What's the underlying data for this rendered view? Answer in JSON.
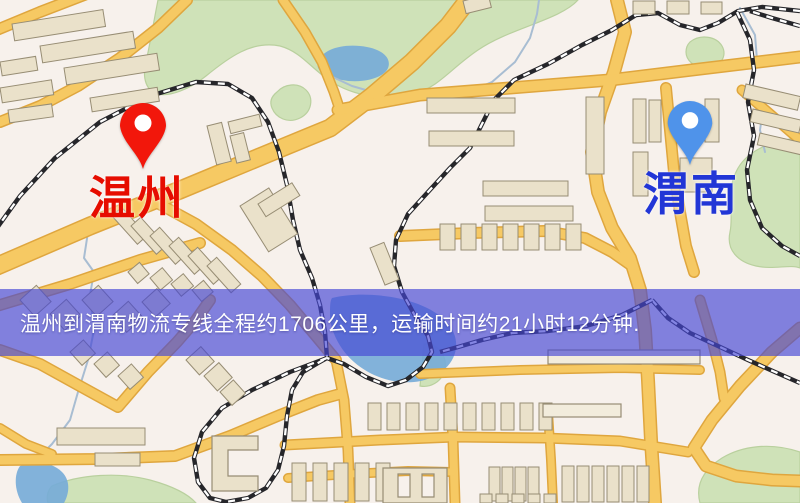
{
  "map": {
    "canvas": {
      "width": 800,
      "height": 503
    },
    "colors": {
      "bg": "#f7f1ec",
      "green": "#cfe2b8",
      "green_stroke": "#b9d09e",
      "water": "#74abd8",
      "stream": "#a8bdd2",
      "road_casing": "#dfa63e",
      "road_fill": "#f6c963",
      "building": "#eae1ca",
      "building_light": "#f2ecdc",
      "building_stroke": "#978d74",
      "rail_dark": "#26262a",
      "rail_light": "#ffffff"
    },
    "markers": [
      {
        "name": "wenzhou",
        "label": "温州",
        "pin_color": "#f2170b",
        "hole_color": "#ffffff",
        "label_color": "#e60d00",
        "pin_x": 143,
        "pin_top": 101,
        "label_center_x": 137
      },
      {
        "name": "weinan",
        "label": "渭南",
        "pin_color": "#4f93ea",
        "hole_color": "#ffffff",
        "label_color": "#2236d6",
        "pin_x": 690,
        "pin_top": 99,
        "label_center_x": 691
      }
    ],
    "banner": {
      "text": "温州到渭南物流专线全程约1706公里，运输时间约21小时12分钟.",
      "top": 289,
      "height": 67,
      "pad_left": 20,
      "bg": "rgba(68,70,213,0.66)",
      "text_color": "#ffffff"
    },
    "geometry": {
      "greens": [
        "M158,0 L578,0 C560,20 510,28 478,50 C450,69 438,88 412,95 C386,102 352,95 332,82 C312,70 302,52 280,46 C252,40 228,58 206,76 C190,89 170,97 158,94 C146,91 142,78 146,62 C150,44 154,20 158,0 Z",
        "M277,92 C284,84 298,82 306,90 C314,98 312,112 300,118 C288,124 276,118 272,108 C269,101 272,96 277,92 Z",
        "M800,138 C770,140 745,152 736,172 C726,192 734,214 730,232 C726,250 738,262 756,266 C774,270 790,264 800,268 Z",
        "M800,452 C770,442 742,446 722,458 C700,472 696,488 700,503 L800,503 Z",
        "M52,486 C80,474 120,472 150,480 C172,486 188,494 196,503 L48,503 C46,497 48,490 52,486 Z",
        "M690,42 C700,34 716,36 722,46 C728,56 720,68 706,68 C694,68 686,60 686,52 C686,48 687,45 690,42 Z",
        "M430,344 C442,348 448,360 444,372 C441,382 430,388 420,386 L424,344 Z"
      ],
      "waters": [
        "M318,62 C322,50 340,44 360,46 C382,48 392,58 388,68 C384,78 362,84 342,80 C326,77 315,71 318,62 Z",
        "M332,298 C356,292 392,294 418,304 C444,314 458,330 456,348 C454,366 436,380 414,382 C392,384 370,376 354,362 C340,350 330,330 330,316 C330,306 330,301 332,298 Z",
        "M20,466 C34,460 52,462 62,472 C70,480 70,492 64,503 L22,503 C14,490 14,474 20,466 Z"
      ],
      "streams": [
        "322,72 352,86 390,97 430,100 458,96 492,82 515,62 530,38 537,14 539,0",
        "740,8 755,35 757,60 750,82 764,102 760,130 765,152",
        "98,205 88,232 84,258 94,272 90,295 94,330 88,360 78,392 70,420 52,444 34,462"
      ],
      "roads": [
        {
          "p": "-12,270 90,226 180,190 262,156 330,128 372,96 412,62 448,26 468,0",
          "w": 16
        },
        {
          "p": "-10,308 70,284 140,260 200,243",
          "w": 9
        },
        {
          "p": "152,200 196,224 232,250 262,276 290,305 316,336 336,360",
          "w": 9
        },
        {
          "p": "210,300 196,320 177,342 148,372 118,407 78,385 40,364 0,350",
          "w": 9
        },
        {
          "p": "0,460 100,459 175,456 230,436 280,415 318,400 340,394",
          "w": 9
        },
        {
          "p": "0,428 26,444 52,454",
          "w": 7
        },
        {
          "p": "187,0 158,28 120,58 78,86 40,106 0,122",
          "w": 9
        },
        {
          "p": "283,0 305,32 322,62 334,92 340,110",
          "w": 8
        },
        {
          "p": "-8,32 40,12 92,-8",
          "w": 9
        },
        {
          "p": "617,0 625,32 614,72 600,112 592,152 598,192 612,228 630,258 640,290 645,330 648,380 651,440 655,503",
          "w": 11
        },
        {
          "p": "338,110 420,95 510,88 610,80 700,69 800,57",
          "w": 10
        },
        {
          "p": "400,236 470,233 545,231 585,238 612,252 632,266",
          "w": 9
        },
        {
          "p": "666,88 670,130 674,172 680,212 686,246 694,272",
          "w": 9
        },
        {
          "p": "700,300 712,340 720,372 724,398",
          "w": 8
        },
        {
          "p": "742,90 770,114 800,140",
          "w": 8
        },
        {
          "p": "800,328 772,352 740,386 712,420 694,448 706,466 736,476 772,480 800,481",
          "w": 10
        },
        {
          "p": "336,360 344,400 348,450 350,503",
          "w": 8
        },
        {
          "p": "450,388 453,440 455,503",
          "w": 8
        },
        {
          "p": "285,445 380,440 455,437 545,438 620,441 688,452",
          "w": 8
        },
        {
          "p": "288,478 350,474 408,471 452,472",
          "w": 7
        },
        {
          "p": "420,374 520,370 620,368 700,370",
          "w": 7
        },
        {
          "p": "548,412 551,460 553,503",
          "w": 7
        }
      ],
      "rails": [
        "-6,232 20,196 55,158 100,122 150,96 196,82 228,84 252,98 268,122 279,152 287,185 293,220 300,250 312,278 320,305 325,332 327,358",
        "327,358 290,372 252,390 222,408 202,432 194,458 198,482 210,498 226,502 248,498 266,488 278,470 284,446 287,416 292,390 303,372 318,363 327,358",
        "800,11 762,7 738,11 718,23 700,30 680,25 658,13 636,15 612,30 582,45 548,64 514,80 494,100 481,126 470,148 450,168 428,192 408,214 396,240 394,266 402,292 414,314 428,336 432,352 423,367 406,380 388,386 366,377 344,364 327,358",
        "652,300 668,318 690,333 718,346 748,360 775,372 800,383",
        "652,300 622,315 586,326 548,331 512,333 482,340 458,347 440,352",
        "737,12 750,40 754,70 748,102 754,136 747,170 750,200 762,228 782,246 800,256",
        "800,26 772,18 750,11"
      ],
      "buildings": [
        [
          12,
          24,
          92,
          17,
          -9
        ],
        [
          40,
          46,
          94,
          17,
          -9
        ],
        [
          64,
          68,
          94,
          17,
          -9
        ],
        [
          0,
          62,
          36,
          14,
          -9
        ],
        [
          0,
          88,
          52,
          15,
          -9
        ],
        [
          8,
          110,
          44,
          13,
          -8
        ],
        [
          90,
          98,
          68,
          14,
          -9
        ],
        [
          207,
          126,
          15,
          40,
          -14
        ],
        [
          228,
          122,
          32,
          12,
          -14
        ],
        [
          230,
          136,
          14,
          28,
          -14
        ],
        [
          240,
          206,
          34,
          54,
          -32
        ],
        [
          258,
          204,
          40,
          15,
          -32
        ],
        [
          112,
          216,
          13,
          38,
          -42
        ],
        [
          131,
          226,
          13,
          38,
          -42
        ],
        [
          150,
          236,
          13,
          38,
          -42
        ],
        [
          169,
          246,
          13,
          38,
          -42
        ],
        [
          188,
          256,
          13,
          38,
          -42
        ],
        [
          207,
          266,
          13,
          36,
          -42
        ],
        [
          128,
          272,
          15,
          15,
          -40
        ],
        [
          150,
          278,
          16,
          16,
          -40
        ],
        [
          171,
          284,
          16,
          16,
          -40
        ],
        [
          192,
          290,
          15,
          15,
          -40
        ],
        [
          370,
          248,
          15,
          40,
          -22
        ],
        [
          427,
          98,
          88,
          15,
          0
        ],
        [
          429,
          131,
          85,
          15,
          0
        ],
        [
          586,
          97,
          18,
          77,
          0
        ],
        [
          483,
          181,
          85,
          15,
          0
        ],
        [
          485,
          206,
          88,
          15,
          0
        ],
        [
          440,
          224,
          15,
          26,
          0
        ],
        [
          461,
          224,
          15,
          26,
          0
        ],
        [
          482,
          224,
          15,
          26,
          0
        ],
        [
          503,
          224,
          15,
          26,
          0
        ],
        [
          524,
          224,
          15,
          26,
          0
        ],
        [
          545,
          224,
          15,
          26,
          0
        ],
        [
          566,
          224,
          15,
          26,
          0
        ],
        [
          633,
          99,
          13,
          44,
          0
        ],
        [
          649,
          100,
          12,
          42,
          0
        ],
        [
          705,
          99,
          14,
          43,
          0
        ],
        [
          633,
          152,
          15,
          44,
          0
        ],
        [
          680,
          158,
          32,
          34,
          0
        ],
        [
          463,
          1,
          26,
          13,
          -14
        ],
        [
          633,
          1,
          22,
          13,
          0
        ],
        [
          667,
          1,
          22,
          13,
          0
        ],
        [
          701,
          2,
          21,
          12,
          0
        ],
        [
          746,
          84,
          56,
          14,
          13
        ],
        [
          753,
          109,
          50,
          13,
          13
        ],
        [
          760,
          133,
          46,
          12,
          13
        ],
        [
          186,
          360,
          20,
          20,
          -42
        ],
        [
          204,
          376,
          20,
          20,
          -42
        ],
        [
          220,
          392,
          18,
          18,
          -42
        ],
        [
          70,
          352,
          18,
          18,
          -42
        ],
        [
          94,
          364,
          18,
          18,
          -42
        ],
        [
          118,
          376,
          18,
          18,
          -42
        ],
        [
          20,
          300,
          22,
          22,
          -42
        ],
        [
          50,
          314,
          22,
          22,
          -42
        ],
        [
          82,
          300,
          22,
          22,
          -42
        ],
        [
          112,
          316,
          22,
          22,
          -42
        ],
        [
          142,
          302,
          20,
          20,
          -42
        ],
        [
          368,
          403,
          13,
          27,
          0
        ],
        [
          387,
          403,
          13,
          27,
          0
        ],
        [
          406,
          403,
          13,
          27,
          0
        ],
        [
          425,
          403,
          13,
          27,
          0
        ],
        [
          444,
          403,
          13,
          27,
          0
        ],
        [
          463,
          403,
          13,
          27,
          0
        ],
        [
          482,
          403,
          13,
          27,
          0
        ],
        [
          501,
          403,
          13,
          27,
          0
        ],
        [
          520,
          403,
          13,
          27,
          0
        ],
        [
          539,
          403,
          13,
          27,
          0
        ],
        [
          292,
          463,
          14,
          38,
          0
        ],
        [
          313,
          463,
          14,
          38,
          0
        ],
        [
          334,
          463,
          14,
          38,
          0
        ],
        [
          355,
          463,
          14,
          38,
          0
        ],
        [
          376,
          463,
          14,
          38,
          0
        ],
        [
          489,
          467,
          11,
          34,
          0
        ],
        [
          502,
          467,
          11,
          34,
          0
        ],
        [
          515,
          467,
          11,
          34,
          0
        ],
        [
          528,
          467,
          11,
          34,
          0
        ],
        [
          562,
          466,
          12,
          36,
          0
        ],
        [
          577,
          466,
          12,
          36,
          0
        ],
        [
          592,
          466,
          12,
          36,
          0
        ],
        [
          607,
          466,
          12,
          36,
          0
        ],
        [
          622,
          466,
          12,
          36,
          0
        ],
        [
          637,
          466,
          12,
          36,
          0
        ],
        [
          57,
          428,
          88,
          17,
          0
        ],
        [
          95,
          453,
          45,
          13,
          0
        ],
        [
          480,
          494,
          12,
          9,
          0
        ],
        [
          496,
          494,
          12,
          9,
          0
        ],
        [
          512,
          494,
          12,
          9,
          0
        ],
        [
          528,
          494,
          12,
          9,
          0
        ],
        [
          544,
          494,
          12,
          9,
          0
        ]
      ],
      "outlines": [
        [
          548,
          350,
          152,
          14
        ],
        [
          543,
          404,
          78,
          13
        ]
      ],
      "specials": [
        "M258,436 L212,436 L212,491 L258,491 L258,476 L228,476 L228,450 L258,450 Z",
        "M383,468 L447,468 L447,503 L383,503 Z M398,474 L410,474 L410,497 L398,497 Z M422,474 L434,474 L434,497 L422,497 Z"
      ]
    }
  }
}
